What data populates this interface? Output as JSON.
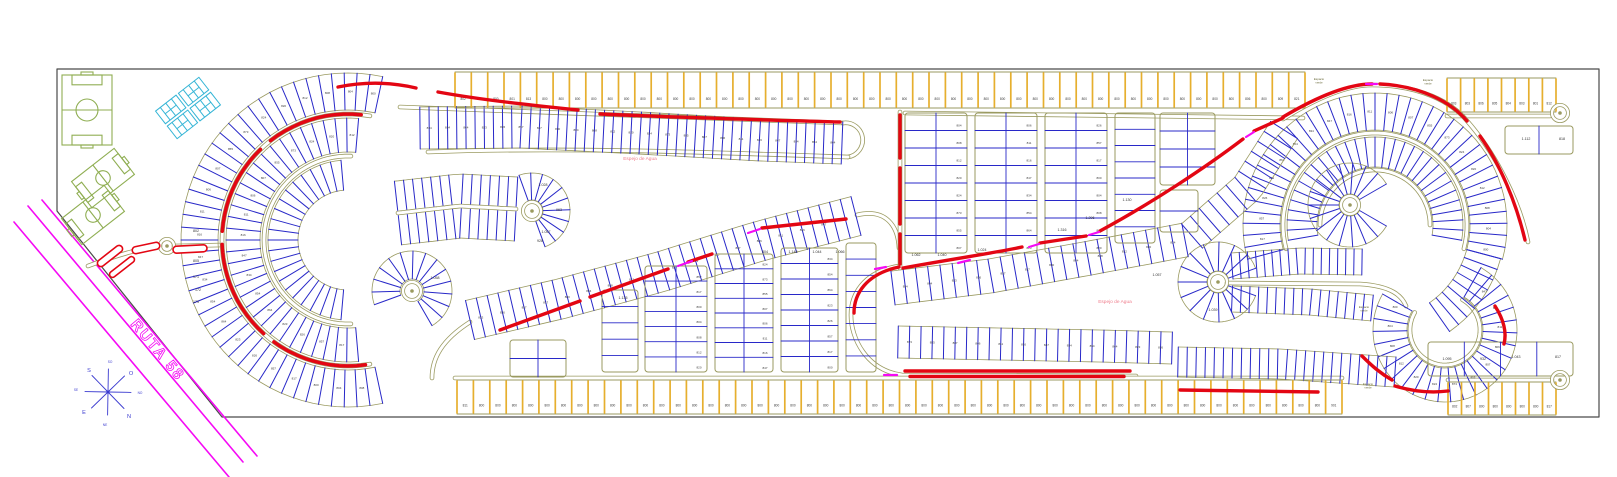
{
  "labels": {
    "ruta": "RUTA 58",
    "lake": "Espejo de Agua",
    "green_space": "Espacio verde",
    "compass": {
      "n": "N",
      "s": "S",
      "e": "E",
      "o": "O",
      "ne": "NE",
      "no": "NO",
      "se": "SE",
      "so": "SO"
    }
  },
  "colors": {
    "road_outline": "#9a9a60",
    "lot_divider": "#2828c8",
    "strip_divider": "#e6af2e",
    "highlight_route": "#e30613",
    "ruta_road": "#f50af5",
    "sports_field": "#8fae52",
    "courts": "#35b5d6",
    "lake_text": "#ef7d8c",
    "border": "#4a4a4a",
    "number_text": "#3c3c3c"
  },
  "number_pool": [
    "800",
    "804",
    "808",
    "812",
    "820",
    "824",
    "873",
    "855",
    "807",
    "806",
    "811",
    "816",
    "847",
    "834",
    "854",
    "864",
    "823",
    "826",
    "857",
    "817"
  ],
  "strips": {
    "top": {
      "x": 455,
      "y": 72,
      "len": 850,
      "h": 36,
      "n": 52,
      "nums": [
        "802",
        "800",
        "800",
        "801",
        "813",
        "800",
        "800",
        "800",
        "800",
        "800",
        "800",
        "800",
        "800",
        "800",
        "800",
        "800",
        "800",
        "800",
        "800",
        "800",
        "800",
        "800",
        "800",
        "800",
        "800",
        "800",
        "800",
        "800",
        "800",
        "800",
        "800",
        "800",
        "800",
        "800",
        "800",
        "800",
        "800",
        "800",
        "800",
        "800",
        "800",
        "800",
        "800",
        "800",
        "800",
        "800",
        "800",
        "800",
        "806",
        "800",
        "809",
        "821"
      ]
    },
    "bottom": {
      "x": 457,
      "y": 380,
      "len": 885,
      "h": 34,
      "n": 54,
      "nums": [
        "811",
        "800",
        "800",
        "800",
        "800",
        "800",
        "800",
        "800",
        "800",
        "800",
        "800",
        "800",
        "800",
        "800",
        "800",
        "800",
        "800",
        "800",
        "800",
        "800",
        "800",
        "800",
        "800",
        "800",
        "800",
        "800",
        "800",
        "800",
        "800",
        "800",
        "800",
        "800",
        "800",
        "800",
        "800",
        "800",
        "800",
        "800",
        "800",
        "800",
        "800",
        "800",
        "800",
        "800",
        "800",
        "800",
        "800",
        "800",
        "800",
        "800",
        "800",
        "800",
        "800",
        "901"
      ]
    },
    "top_right": {
      "x": 1447,
      "y": 78,
      "len": 109,
      "h": 34,
      "n": 8,
      "nums": [
        "803",
        "803",
        "806",
        "805",
        "804",
        "803",
        "801",
        "812"
      ]
    },
    "bottom_right": {
      "x": 1448,
      "y": 382,
      "len": 108,
      "h": 33,
      "n": 8,
      "nums": [
        "802",
        "807",
        "800",
        "800",
        "800",
        "800",
        "800",
        "817"
      ]
    }
  },
  "featured_numbers": [
    [
      "171",
      196,
      278
    ],
    [
      "172",
      198,
      291
    ],
    [
      "173",
      196,
      303
    ],
    [
      "802",
      196,
      232
    ],
    [
      "805",
      196,
      262
    ],
    [
      "1.028",
      543,
      186
    ],
    [
      "963",
      559,
      211
    ],
    [
      "1.057",
      546,
      233
    ],
    [
      "928",
      540,
      242
    ],
    [
      "804",
      765,
      253
    ],
    [
      "1.148",
      793,
      253
    ],
    [
      "1.044",
      817,
      253
    ],
    [
      "1.066",
      840,
      253
    ],
    [
      "1.135",
      623,
      299
    ],
    [
      "1.062",
      916,
      256
    ],
    [
      "1.040",
      942,
      256
    ],
    [
      "1.024",
      982,
      251
    ],
    [
      "1.130",
      1127,
      201
    ],
    [
      "1.296",
      1090,
      219
    ],
    [
      "1.316",
      1062,
      231
    ],
    [
      "1.112",
      1526,
      140
    ],
    [
      "818",
      1562,
      140
    ],
    [
      "1.095",
      1447,
      360
    ],
    [
      "932",
      1483,
      360
    ],
    [
      "1.043",
      1516,
      358
    ],
    [
      "817",
      1558,
      358
    ],
    [
      "1.039",
      1213,
      311
    ],
    [
      "1.057",
      1157,
      276
    ],
    [
      "1.058",
      435,
      279
    ]
  ],
  "lake_labels": [
    [
      640,
      158
    ],
    [
      1115,
      301
    ]
  ],
  "green_labels": [
    [
      1319,
      80
    ],
    [
      1428,
      81
    ],
    [
      1364,
      308
    ],
    [
      1368,
      385
    ]
  ],
  "geometry": {
    "border": [
      [
        57,
        69
      ],
      [
        1599,
        69
      ],
      [
        1599,
        417
      ],
      [
        222,
        417
      ],
      [
        57,
        211
      ]
    ],
    "ruta_lines": [
      [
        28,
        206,
        243,
        462
      ],
      [
        42,
        200,
        257,
        456
      ],
      [
        14,
        222,
        229,
        477
      ]
    ],
    "compass": {
      "cx": 108,
      "cy": 392,
      "r": 23,
      "angles": [
        1,
        46,
        91,
        136,
        181,
        226,
        271,
        316
      ]
    },
    "fields": [
      {
        "cx": 87,
        "cy": 110,
        "w": 70,
        "h": 50,
        "rot": 90
      },
      {
        "cx": 103,
        "cy": 178,
        "w": 54,
        "h": 33,
        "rot": -38
      },
      {
        "cx": 93,
        "cy": 215,
        "w": 54,
        "h": 33,
        "rot": -38
      }
    ],
    "courts": {
      "cx": 188,
      "cy": 108,
      "rot": -38
    },
    "pills": [
      {
        "cx": 110,
        "cy": 256,
        "l": 30,
        "w": 7,
        "rot": -38
      },
      {
        "cx": 122,
        "cy": 267,
        "l": 30,
        "w": 6,
        "rot": -38
      },
      {
        "cx": 146,
        "cy": 248,
        "l": 28,
        "w": 7,
        "rot": -12
      },
      {
        "cx": 190,
        "cy": 249,
        "l": 34,
        "w": 7,
        "rot": -3
      }
    ],
    "culdesacs": [
      [
        167,
        246,
        7
      ],
      [
        412,
        291,
        9
      ],
      [
        532,
        211,
        9
      ],
      [
        1350,
        205,
        9
      ],
      [
        1218,
        282,
        9
      ],
      [
        1560,
        113,
        8
      ],
      [
        1560,
        380,
        8
      ]
    ],
    "rings": [
      {
        "cx": 348,
        "cy": 240,
        "r0": 130,
        "r1": 167,
        "a0": 78,
        "a1": 282,
        "n": 46,
        "nums": true
      },
      {
        "cx": 348,
        "cy": 240,
        "r0": 88,
        "r1": 122,
        "a0": 85,
        "a1": 275,
        "n": 34,
        "nums": true
      },
      {
        "cx": 348,
        "cy": 240,
        "r0": 50,
        "r1": 80,
        "a0": 95,
        "a1": 265,
        "n": 22
      },
      {
        "cx": 412,
        "cy": 291,
        "r0": 12,
        "r1": 40,
        "a0": -60,
        "a1": 200,
        "n": 14
      },
      {
        "cx": 532,
        "cy": 211,
        "r0": 11,
        "r1": 38,
        "a0": -70,
        "a1": 110,
        "n": 10
      },
      {
        "cx": 1375,
        "cy": 225,
        "r0": 95,
        "r1": 132,
        "a0": -15,
        "a1": 195,
        "n": 40,
        "nums": true
      },
      {
        "cx": 1375,
        "cy": 225,
        "r0": 95,
        "r1": 130,
        "a0": -55,
        "a1": -15,
        "n": 8
      },
      {
        "cx": 1375,
        "cy": 225,
        "r0": 58,
        "r1": 88,
        "a0": -10,
        "a1": 190,
        "n": 30
      },
      {
        "cx": 1350,
        "cy": 205,
        "r0": 11,
        "r1": 42,
        "a0": 30,
        "a1": 330,
        "n": 16
      },
      {
        "cx": 1218,
        "cy": 282,
        "r0": 11,
        "r1": 40,
        "a0": 20,
        "a1": 340,
        "n": 14
      },
      {
        "cx": 1445,
        "cy": 330,
        "r0": 38,
        "r1": 72,
        "a0": 150,
        "a1": 420,
        "n": 26,
        "nums": true
      }
    ],
    "ring_roads": [
      {
        "cx": 348,
        "cy": 240,
        "r": 126,
        "a0": 80,
        "a1": 280
      },
      {
        "cx": 348,
        "cy": 240,
        "r": 84,
        "a0": 88,
        "a1": 272
      },
      {
        "cx": 1375,
        "cy": 225,
        "r": 92,
        "a0": -15,
        "a1": 195
      },
      {
        "cx": 1375,
        "cy": 225,
        "r": 55,
        "a0": 0,
        "a1": 180
      },
      {
        "cx": 1445,
        "cy": 330,
        "r": 35,
        "a0": 150,
        "a1": 420
      }
    ],
    "bands": [
      {
        "pts": [
          [
            420,
            128
          ],
          [
            520,
            127
          ],
          [
            640,
            133
          ],
          [
            760,
            140
          ],
          [
            842,
            143
          ]
        ],
        "hw": 21,
        "n": 46,
        "nums": true
      },
      {
        "pts": [
          [
            470,
            320
          ],
          [
            560,
            299
          ],
          [
            660,
            272
          ],
          [
            760,
            241
          ],
          [
            856,
            216
          ]
        ],
        "hw": 20,
        "n": 36,
        "nums": true
      },
      {
        "pts": [
          [
            893,
            288
          ],
          [
            990,
            276
          ],
          [
            1090,
            258
          ],
          [
            1185,
            240
          ]
        ],
        "hw": 17,
        "n": 24,
        "nums": true
      },
      {
        "pts": [
          [
            1192,
            236
          ],
          [
            1247,
            188
          ],
          [
            1284,
            130
          ]
        ],
        "hw": 16,
        "n": 12
      },
      {
        "pts": [
          [
            898,
            342
          ],
          [
            1000,
            344
          ],
          [
            1100,
            346
          ],
          [
            1172,
            348
          ]
        ],
        "hw": 16,
        "n": 24,
        "nums": true
      },
      {
        "pts": [
          [
            1178,
            362
          ],
          [
            1280,
            364
          ],
          [
            1395,
            372
          ]
        ],
        "hw": 15,
        "n": 24
      },
      {
        "pts": [
          [
            1232,
            266
          ],
          [
            1300,
            261
          ],
          [
            1362,
            262
          ]
        ],
        "hw": 13,
        "n": 16
      },
      {
        "pts": [
          [
            1232,
            299
          ],
          [
            1310,
            302
          ],
          [
            1372,
            308
          ]
        ],
        "hw": 13,
        "n": 16
      },
      {
        "pts": [
          [
            398,
            213
          ],
          [
            460,
            206
          ],
          [
            516,
            209
          ]
        ],
        "hw": 32,
        "n": 13,
        "road": true
      }
    ],
    "roads": [
      "M 88,266 C 120,254 142,248 160,246",
      "M 174,246 L 222,245",
      "M 400,107 C 560,114 720,119 843,123",
      "M 843,123 A 17 17 0 0 1 848,157",
      "M 848,157 C 700,152 560,147 428,152",
      "M 905,113 C 1080,116 1220,117 1303,118",
      "M 470,322 C 442,340 432,358 432,378",
      "M 857,215 C 886,208 898,226 899,248",
      "M 899,266 C 862,272 851,296 851,315 C 851,338 866,370 902,375 L 1136,376",
      "M 1227,283 L 1360,284 C 1392,286 1402,296 1406,306",
      "M 1447,116 L 1550,116",
      "M 455,378 L 1342,378",
      "M 1448,380 L 1552,380",
      "M 1283,119 C 1320,96 1350,85 1372,85 C 1420,85 1452,102 1468,122 C 1496,154 1520,202 1528,242",
      "M 900,112 L 900,268"
    ],
    "red_arcs": [
      {
        "cx": 348,
        "cy": 240,
        "r": 126,
        "a0": 84,
        "a1": 128
      },
      {
        "cx": 348,
        "cy": 240,
        "r": 126,
        "a0": 134,
        "a1": 176
      },
      {
        "cx": 348,
        "cy": 240,
        "r": 126,
        "a0": 182,
        "a1": 228
      },
      {
        "cx": 348,
        "cy": 240,
        "r": 126,
        "a0": 234,
        "a1": 278
      }
    ],
    "reds": [
      "M 338,87 Q 378,79 416,88",
      "M 438,92 C 482,100 530,105 578,110",
      "M 600,114 C 690,118 770,120 840,122",
      "M 500,330 L 580,301",
      "M 590,297 L 668,269",
      "M 688,262 L 712,254",
      "M 762,228 L 846,219",
      "M 900,115 L 900,158",
      "M 900,168 L 900,224",
      "M 900,234 L 900,264",
      "M 899,267 C 866,274 854,294 854,313",
      "M 905,371 L 1130,371",
      "M 910,376.5 L 1124,376.5",
      "M 903,268 C 958,258 1000,252 1022,247",
      "M 1040,243 L 1086,236",
      "M 1100,231 C 1150,204 1205,168 1243,139",
      "M 1254,131 L 1283,118",
      "M 1283,117 C 1320,95 1350,84 1372,84",
      "M 1380,84 C 1422,86 1452,103 1467,121",
      "M 1480,136 C 1500,164 1516,202 1525,240",
      "M 1495,306 C 1504,320 1507,332 1504,344",
      "M 1362,356 C 1372,366 1380,373 1392,380",
      "M 1180,390 L 1318,392",
      "M 1395,386 C 1415,392 1432,393 1448,391"
    ],
    "mag_dashes": [
      [
        678,
        266,
        692,
        261
      ],
      [
        748,
        233,
        760,
        229
      ],
      [
        1029,
        247,
        1039,
        244
      ],
      [
        1089,
        235,
        1099,
        232
      ],
      [
        1246,
        137,
        1254,
        132
      ],
      [
        1366,
        84,
        1377,
        84
      ],
      [
        875,
        269,
        886,
        267
      ],
      [
        884,
        375,
        897,
        375
      ],
      [
        958,
        263,
        970,
        260
      ]
    ],
    "blocks": [
      {
        "x": 602,
        "y": 290,
        "w": 36,
        "h": 82,
        "rows": 5,
        "cols": 1
      },
      {
        "x": 645,
        "y": 266,
        "w": 62,
        "h": 106,
        "rows": 7,
        "cols": 2,
        "nums": true
      },
      {
        "x": 715,
        "y": 254,
        "w": 58,
        "h": 118,
        "rows": 8,
        "cols": 2,
        "nums": true
      },
      {
        "x": 781,
        "y": 248,
        "w": 57,
        "h": 124,
        "rows": 8,
        "cols": 2,
        "nums": true
      },
      {
        "x": 846,
        "y": 243,
        "w": 30,
        "h": 129,
        "rows": 8,
        "cols": 1
      },
      {
        "x": 510,
        "y": 340,
        "w": 56,
        "h": 37,
        "rows": 2,
        "cols": 2
      },
      {
        "x": 905,
        "y": 113,
        "w": 62,
        "h": 140,
        "rows": 8,
        "cols": 2,
        "nums": true
      },
      {
        "x": 975,
        "y": 113,
        "w": 62,
        "h": 140,
        "rows": 8,
        "cols": 2,
        "nums": true
      },
      {
        "x": 1045,
        "y": 113,
        "w": 62,
        "h": 140,
        "rows": 8,
        "cols": 2,
        "nums": true
      },
      {
        "x": 1115,
        "y": 113,
        "w": 40,
        "h": 130,
        "rows": 8,
        "cols": 1
      },
      {
        "x": 1160,
        "y": 113,
        "w": 55,
        "h": 72,
        "rows": 4,
        "cols": 2
      },
      {
        "x": 1160,
        "y": 190,
        "w": 38,
        "h": 42,
        "rows": 2,
        "cols": 1
      },
      {
        "x": 1505,
        "y": 126,
        "w": 68,
        "h": 28,
        "rows": 1,
        "cols": 2
      },
      {
        "x": 1428,
        "y": 342,
        "w": 145,
        "h": 34,
        "rows": 1,
        "cols": 4
      }
    ]
  },
  "compass_label_positions": {
    "n": [
      129,
      416
    ],
    "o": [
      131,
      373
    ],
    "s": [
      89,
      370
    ],
    "e": [
      84,
      412
    ],
    "no": [
      140,
      393
    ],
    "ne": [
      105,
      424
    ],
    "so": [
      110,
      362
    ],
    "se": [
      76,
      390
    ]
  }
}
